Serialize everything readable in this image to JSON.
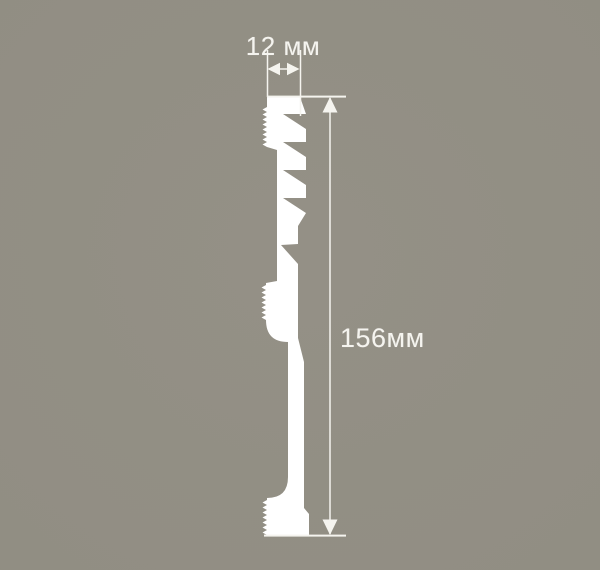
{
  "figure": {
    "type": "technical-cross-section",
    "subject": "moulding-profile"
  },
  "dimensions": {
    "width_label": "12 мм",
    "width_mm": 12,
    "height_label": "156мм",
    "height_mm": 156
  },
  "colors": {
    "background": "#918e83",
    "background_light": "#949086",
    "background_dark": "#8b887d",
    "profile_fill": "#ffffff",
    "annotation": "#f5f4ef"
  }
}
